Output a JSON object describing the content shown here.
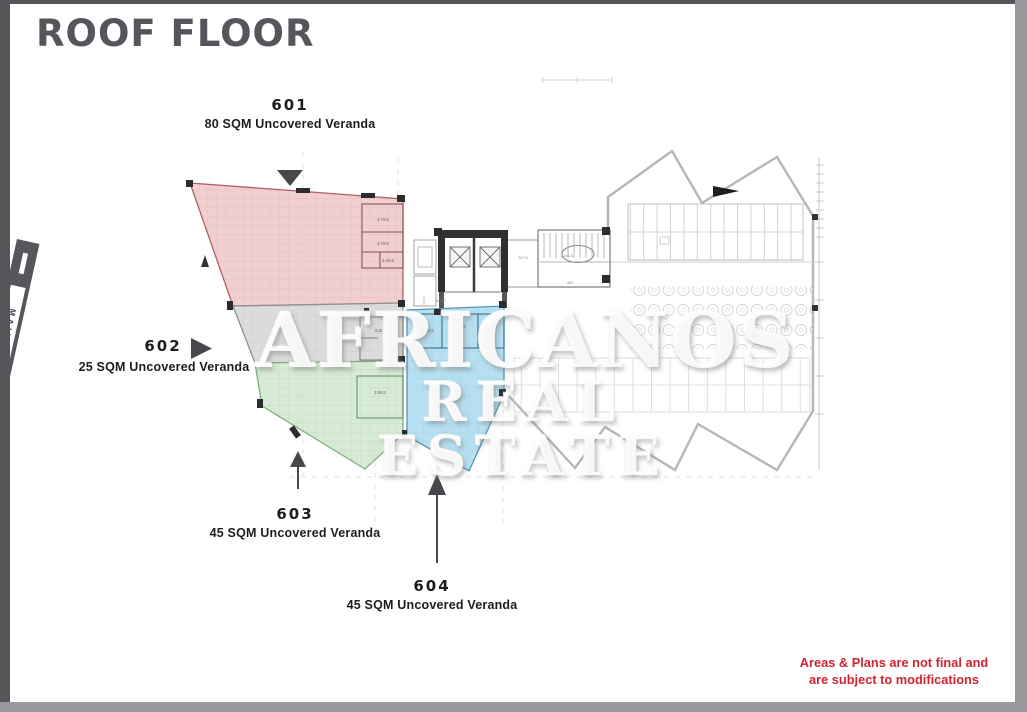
{
  "title": "ROOF FLOOR",
  "watermark": {
    "line1": "AFRICANOS",
    "line2": "REAL ESTATE"
  },
  "disclaimer": {
    "line1": "Areas & Plans are not final and",
    "line2": "are subject to modifications"
  },
  "road": {
    "label": "MAIN ROAD"
  },
  "units": [
    {
      "id": "601",
      "area": "80 SQM Uncovered Veranda",
      "fill": "#efc6c7",
      "border": "#b06064"
    },
    {
      "id": "602",
      "area": "25 SQM Uncovered Veranda",
      "fill": "#d6d6d6",
      "border": "#8f8f8f"
    },
    {
      "id": "603",
      "area": "45 SQM Uncovered Veranda",
      "fill": "#cfe8cb",
      "border": "#7fae7c"
    },
    {
      "id": "604",
      "area": "45 SQM Uncovered Veranda",
      "fill": "#a9daf0",
      "border": "#4f95b5"
    }
  ],
  "plan": {
    "room_areas": [
      "4.7m2",
      "4.7m2",
      "3.4m2",
      "8.2m2",
      "3.5m2",
      "4.9m2",
      "5.4m2",
      "3.9m2"
    ],
    "level_marker": "+40.70",
    "dims": [
      "307.5",
      "181.5",
      "460"
    ]
  },
  "colors": {
    "title": "#54565b",
    "disclaimer": "#ce2531",
    "frame_dark": "#55565a",
    "frame_light": "#97999c",
    "arrow": "#46484b",
    "road": "#56575a"
  }
}
